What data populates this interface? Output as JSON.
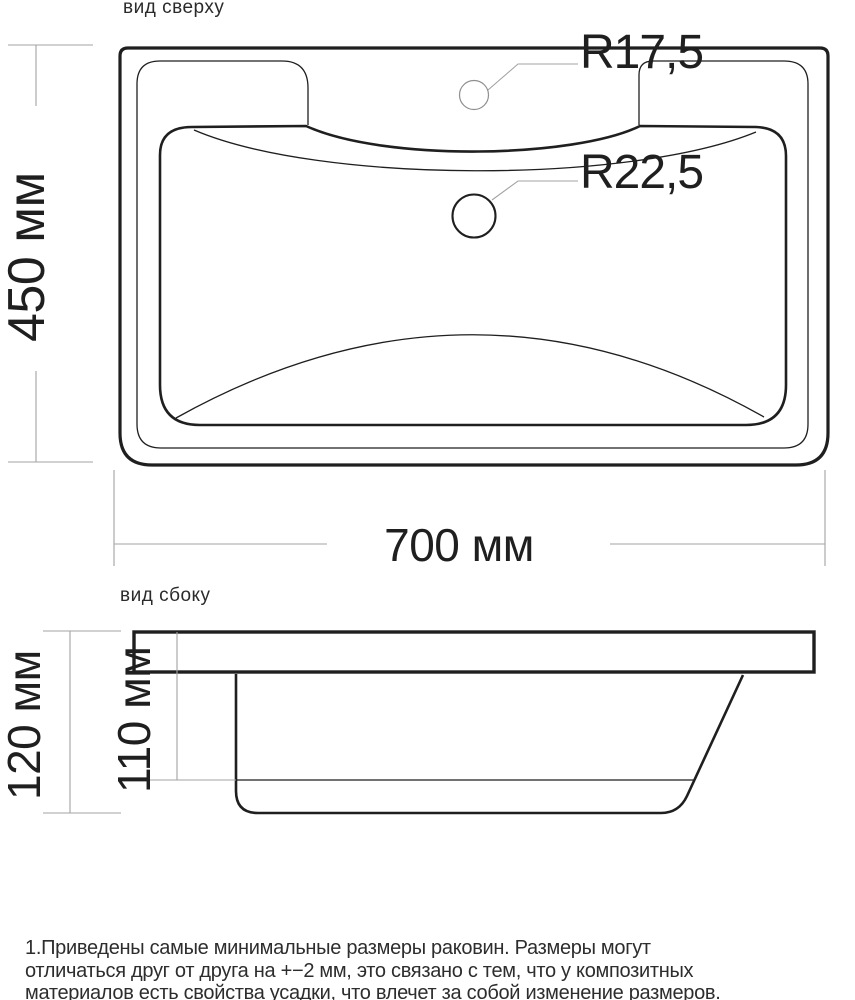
{
  "top_view": {
    "label": "вид сверху",
    "dim_depth": "450 мм",
    "dim_width": "700 мм",
    "faucet_hole_label": "R17,5",
    "drain_hole_label": "R22,5"
  },
  "side_view": {
    "label": "вид сбоку",
    "dim_total_height": "120 мм",
    "dim_bowl_height": "110 мм"
  },
  "notes": {
    "lines": [
      "1.Приведены самые минимальные размеры раковин. Размеры могут",
      "отличаться друг от друга на +−2 мм, это связано с тем, что у композитных",
      "материалов есть свойства усадки, что влечет за собой изменение размеров."
    ]
  },
  "colors": {
    "drawing": "#1f1f1f",
    "dimension": "#a3a3a3",
    "hole": "#8f8f8f",
    "text": "#1f1f1f",
    "note": "#2d2d2d"
  }
}
